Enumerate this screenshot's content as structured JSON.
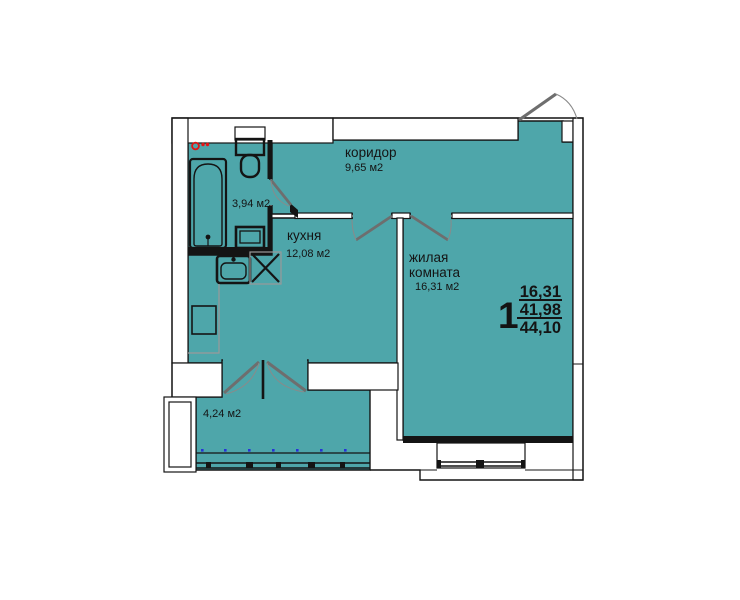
{
  "floor_plan": {
    "rooms": {
      "corridor": {
        "name": "коридор",
        "area": "9,65 м2"
      },
      "bathroom": {
        "area": "3,94 м2"
      },
      "kitchen": {
        "name": "кухня",
        "area": "12,08 м2"
      },
      "living_room": {
        "name_line1": "жилая",
        "name_line2": "комната",
        "area": "16,31 м2"
      },
      "balcony": {
        "area": "4,24 м2"
      }
    },
    "info_block": {
      "room_count": "1",
      "living_area": "16,31",
      "area_without_balcony": "41,98",
      "total_area": "44,10"
    },
    "colors": {
      "room_fill": "#4EA6AA",
      "wall": "#141414",
      "door_leaf": "#6e6e6e",
      "marker_red": "#e41414",
      "window_dot_blue": "#2633d8"
    }
  }
}
